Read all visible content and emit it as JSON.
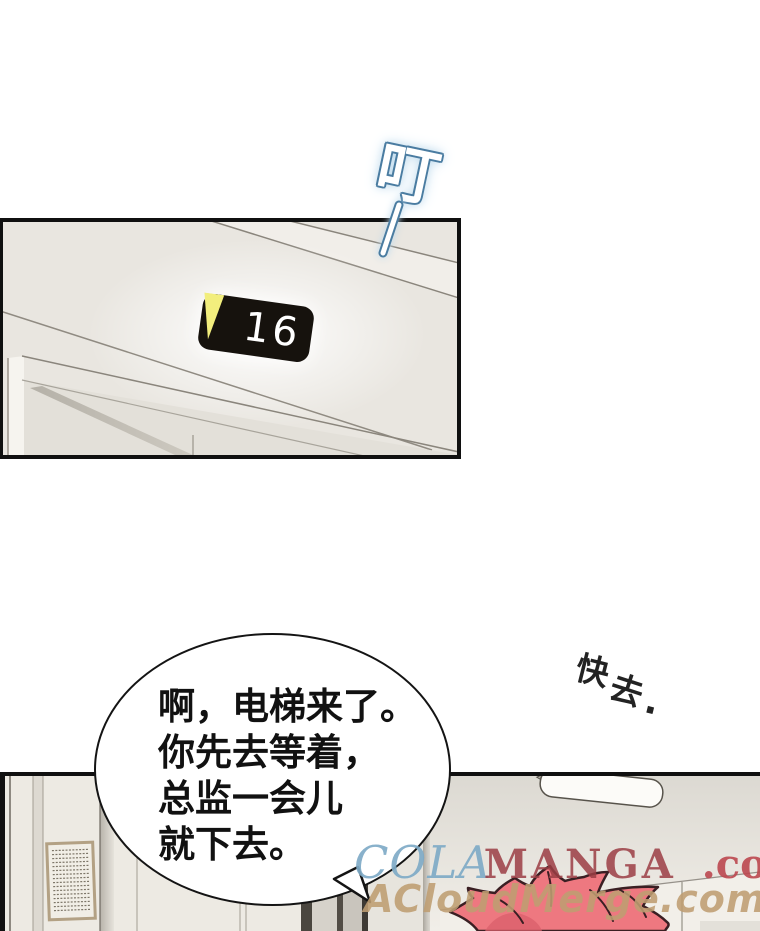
{
  "sfx": {
    "ding": {
      "text": "叮"
    },
    "hurry": {
      "char1": "快",
      "char2": "去",
      "period": "."
    }
  },
  "panel1": {
    "floor_sign": {
      "number": "16",
      "direction": "down"
    }
  },
  "bubble": {
    "line1": "啊，电梯来了。",
    "line2": "你先去等着，",
    "line3": "总监一会儿",
    "line4": "就下去。"
  },
  "watermark": {
    "cola": "COLA",
    "manga": "MANGA",
    "dotcom": ".com",
    "line2": "ACloudMerge.com"
  },
  "colors": {
    "panel_border": "#101010",
    "wall_cream": "#e9e6e0",
    "sign_bg": "#16120d",
    "sign_arrow": "#f2ee7d",
    "sign_text": "#ffffff",
    "sfx_outline_blue": "#4a7ca1",
    "sfx_glow_blue": "#bcd9ec",
    "hair_fill": "#ee7880",
    "hair_shadow": "#d95f6b",
    "hair_outline": "#3a1f23",
    "watermark_blue": "#7fabc7",
    "watermark_darkred": "#9c3e45",
    "watermark_red": "#bc4850",
    "watermark_tan": "#bf9e72"
  }
}
